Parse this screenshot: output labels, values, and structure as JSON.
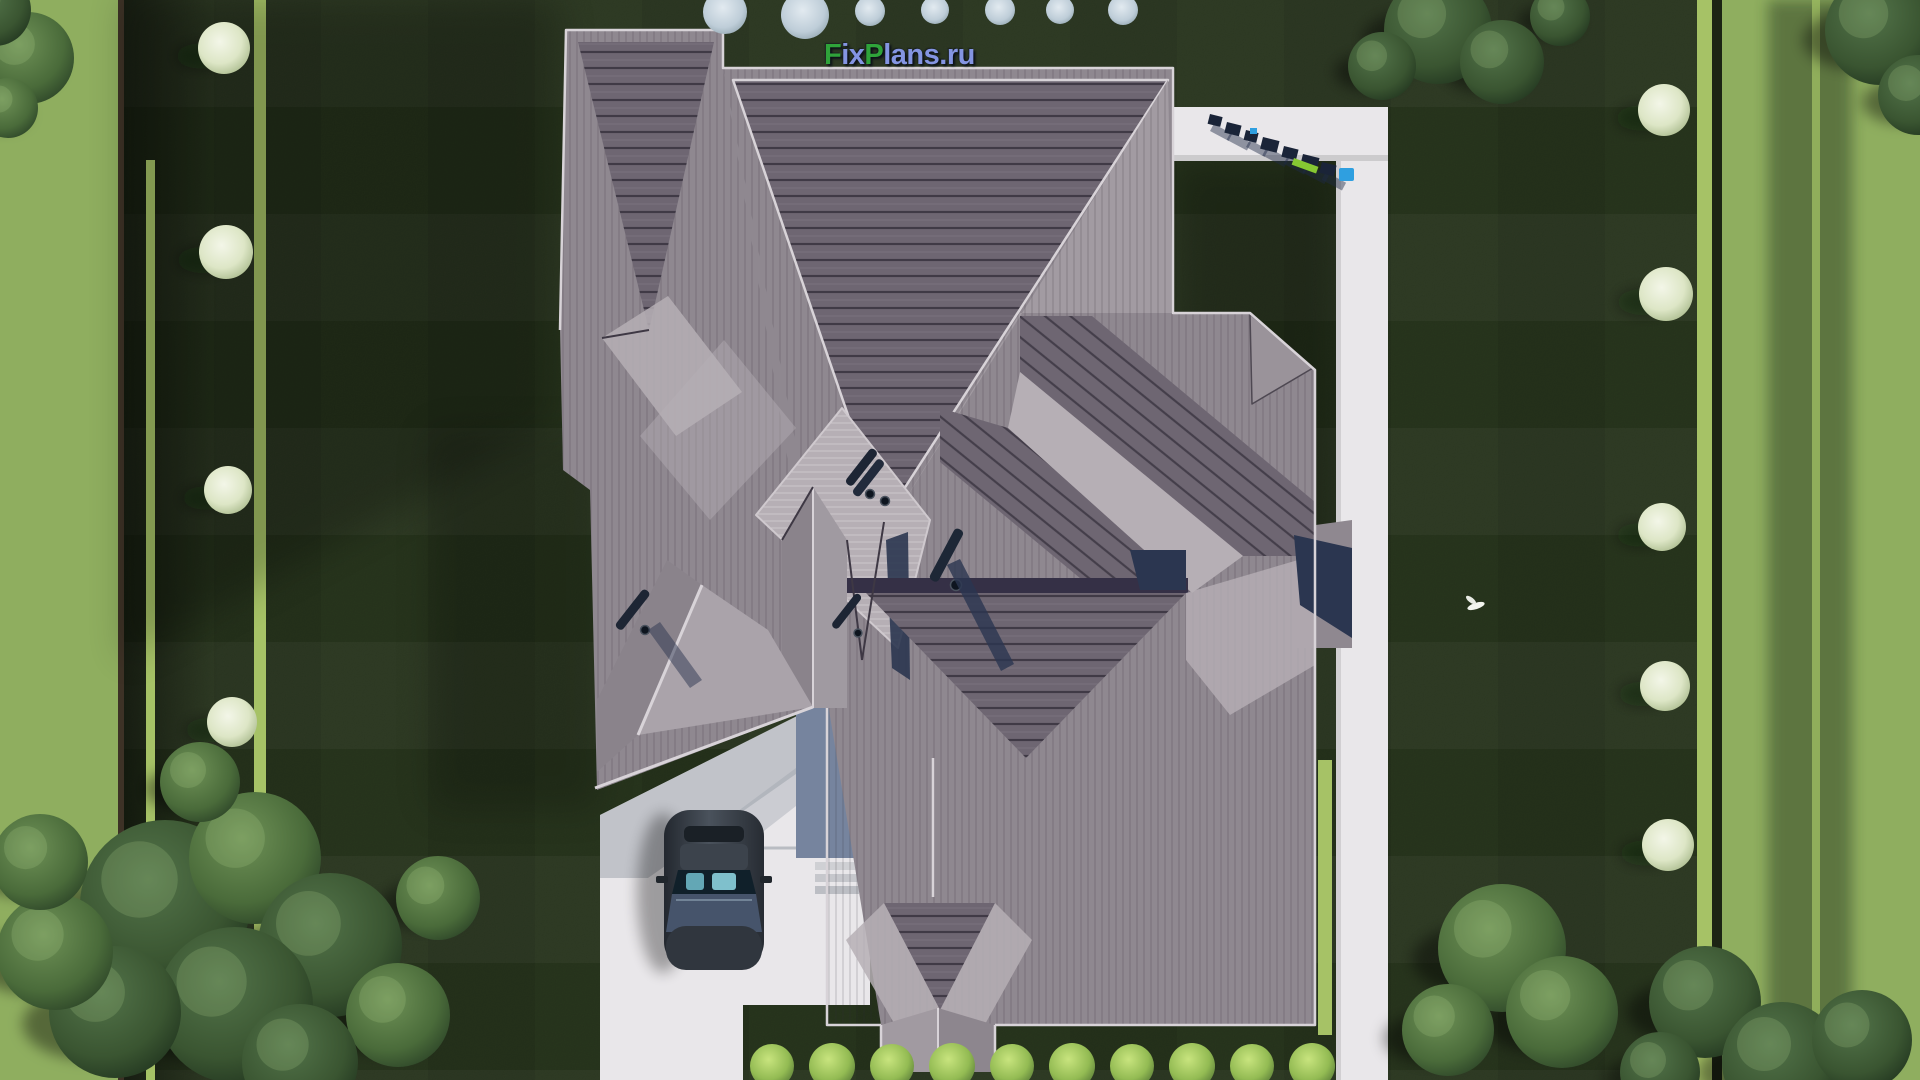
{
  "watermark": {
    "full_text": "FixPlans.ru",
    "parts": [
      {
        "t": "F",
        "c": "green"
      },
      {
        "t": "ix",
        "c": "blue"
      },
      {
        "t": "P",
        "c": "green"
      },
      {
        "t": "lans.ru",
        "c": "blue"
      }
    ]
  },
  "palette": {
    "logo_green": "#2fa33a",
    "logo_blue": "#8495e2",
    "lawn": "#2a381f",
    "lawn_light": "#8fae5f",
    "hedge": "#a6c266",
    "path_white": "#e9e7ea",
    "roof_base": "#8f8890",
    "roof_mid": "#a29ba2",
    "roof_light": "#b6afb5",
    "roof_dark": "#6e6672",
    "roof_ridge": "#d8d3d8",
    "shadow_navy": "#2b3650",
    "wall_blue": "#76849e",
    "car_body": "#343a43",
    "car_glass": "#63a7b5",
    "marker_blue": "#2f9fe0",
    "marker_green": "#86c832"
  },
  "scenery": {
    "green_trees": [
      {
        "x": 165,
        "y": 905,
        "r": 85,
        "tone": "dark"
      },
      {
        "x": 255,
        "y": 858,
        "r": 66,
        "tone": "light"
      },
      {
        "x": 330,
        "y": 945,
        "r": 72,
        "tone": "dark"
      },
      {
        "x": 235,
        "y": 1005,
        "r": 78,
        "tone": "dark"
      },
      {
        "x": 115,
        "y": 1012,
        "r": 66,
        "tone": "dark"
      },
      {
        "x": 55,
        "y": 952,
        "r": 58,
        "tone": "light"
      },
      {
        "x": 398,
        "y": 1015,
        "r": 52,
        "tone": "light"
      },
      {
        "x": 438,
        "y": 898,
        "r": 42,
        "tone": "light"
      },
      {
        "x": 300,
        "y": 1062,
        "r": 58,
        "tone": "dark"
      },
      {
        "x": 40,
        "y": 862,
        "r": 48,
        "tone": "light"
      },
      {
        "x": 200,
        "y": 782,
        "r": 40,
        "tone": "light"
      },
      {
        "x": 28,
        "y": 58,
        "r": 46,
        "tone": "light"
      },
      {
        "x": -5,
        "y": 10,
        "r": 36,
        "tone": "dark"
      },
      {
        "x": 8,
        "y": 108,
        "r": 30,
        "tone": "light"
      },
      {
        "x": 1438,
        "y": 30,
        "r": 54,
        "tone": "dark"
      },
      {
        "x": 1502,
        "y": 62,
        "r": 42,
        "tone": "dark"
      },
      {
        "x": 1382,
        "y": 66,
        "r": 34,
        "tone": "dark"
      },
      {
        "x": 1560,
        "y": 16,
        "r": 30,
        "tone": "dark"
      },
      {
        "x": 1880,
        "y": 30,
        "r": 55,
        "tone": "dark"
      },
      {
        "x": 1918,
        "y": 95,
        "r": 40,
        "tone": "dark"
      },
      {
        "x": 1502,
        "y": 948,
        "r": 64,
        "tone": "light"
      },
      {
        "x": 1562,
        "y": 1012,
        "r": 56,
        "tone": "light"
      },
      {
        "x": 1448,
        "y": 1030,
        "r": 46,
        "tone": "light"
      },
      {
        "x": 1705,
        "y": 1002,
        "r": 56,
        "tone": "dark"
      },
      {
        "x": 1782,
        "y": 1062,
        "r": 60,
        "tone": "dark"
      },
      {
        "x": 1862,
        "y": 1040,
        "r": 50,
        "tone": "dark"
      },
      {
        "x": 1660,
        "y": 1072,
        "r": 40,
        "tone": "dark"
      }
    ],
    "white_trees": [
      {
        "x": 224,
        "y": 48,
        "r": 26
      },
      {
        "x": 226,
        "y": 252,
        "r": 27
      },
      {
        "x": 228,
        "y": 490,
        "r": 24
      },
      {
        "x": 232,
        "y": 722,
        "r": 25
      },
      {
        "x": 1664,
        "y": 110,
        "r": 26
      },
      {
        "x": 1666,
        "y": 294,
        "r": 27
      },
      {
        "x": 1662,
        "y": 527,
        "r": 24
      },
      {
        "x": 1665,
        "y": 686,
        "r": 25
      },
      {
        "x": 1668,
        "y": 845,
        "r": 26
      }
    ],
    "pale_shrubs": [
      {
        "x": 725,
        "y": 12,
        "r": 22
      },
      {
        "x": 805,
        "y": 15,
        "r": 24
      },
      {
        "x": 870,
        "y": 11,
        "r": 15
      },
      {
        "x": 935,
        "y": 10,
        "r": 14
      },
      {
        "x": 1000,
        "y": 10,
        "r": 15
      },
      {
        "x": 1060,
        "y": 10,
        "r": 14
      },
      {
        "x": 1123,
        "y": 10,
        "r": 15
      }
    ],
    "bushes": [
      {
        "x": 772,
        "y": 1066,
        "r": 22
      },
      {
        "x": 832,
        "y": 1066,
        "r": 23
      },
      {
        "x": 892,
        "y": 1066,
        "r": 22
      },
      {
        "x": 952,
        "y": 1066,
        "r": 23
      },
      {
        "x": 1012,
        "y": 1066,
        "r": 22
      },
      {
        "x": 1072,
        "y": 1066,
        "r": 23
      },
      {
        "x": 1132,
        "y": 1066,
        "r": 22
      },
      {
        "x": 1192,
        "y": 1066,
        "r": 23
      },
      {
        "x": 1252,
        "y": 1066,
        "r": 22
      },
      {
        "x": 1312,
        "y": 1066,
        "r": 23
      }
    ],
    "path_letters": [
      {
        "x": 1210,
        "y": 114,
        "w": 13,
        "h": 10
      },
      {
        "x": 1227,
        "y": 122,
        "w": 15,
        "h": 11
      },
      {
        "x": 1246,
        "y": 130,
        "w": 13,
        "h": 10
      },
      {
        "x": 1263,
        "y": 137,
        "w": 17,
        "h": 12
      },
      {
        "x": 1284,
        "y": 146,
        "w": 15,
        "h": 11
      },
      {
        "x": 1303,
        "y": 154,
        "w": 17,
        "h": 12
      },
      {
        "x": 1322,
        "y": 162,
        "w": 15,
        "h": 11
      }
    ],
    "path_marker_blue": {
      "x": 1339,
      "y": 168,
      "w": 15,
      "h": 13
    },
    "path_marker_blue2": {
      "x": 1250,
      "y": 128,
      "w": 7,
      "h": 6
    },
    "path_marker_green": {
      "x": 1294,
      "y": 158,
      "w": 26,
      "h": 7
    }
  }
}
